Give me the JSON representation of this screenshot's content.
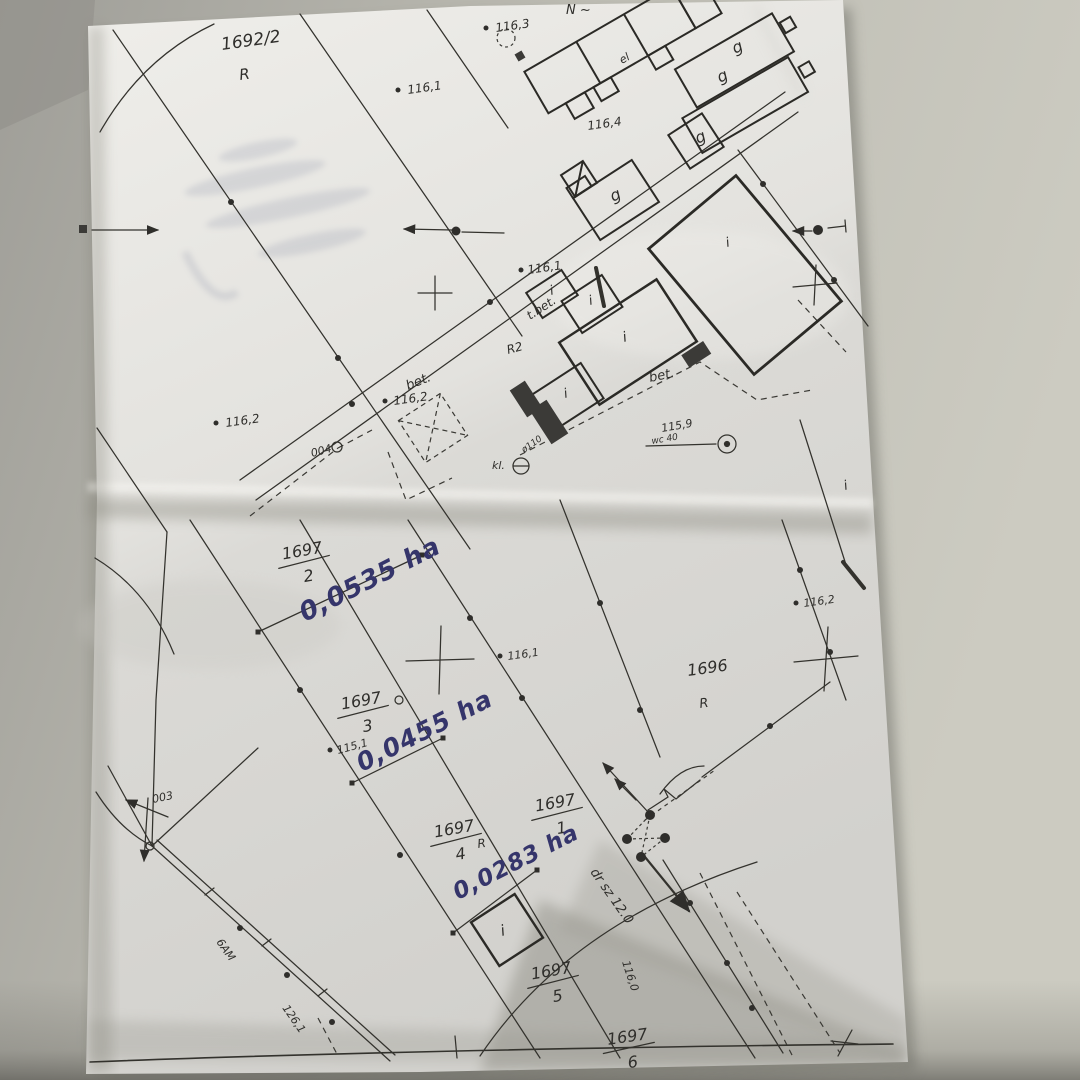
{
  "parcels": {
    "p1692_2": {
      "number": "1692/2",
      "cls": "R"
    },
    "p1696": {
      "number": "1696",
      "cls": "R"
    },
    "p1697_2": {
      "num": "1697",
      "den": "2"
    },
    "p1697_3": {
      "num": "1697",
      "den": "3"
    },
    "p1697_4": {
      "num": "1697",
      "den": "4",
      "cls": "R"
    },
    "p1697_1": {
      "num": "1697",
      "den": "1"
    },
    "p1697_5": {
      "num": "1697",
      "den": "5"
    },
    "p1697_6": {
      "num": "1697",
      "den": "6"
    }
  },
  "areas_handwritten": {
    "a1": "0,0535 ha",
    "a2": "0,0455 ha",
    "a3": "0,0283 ha"
  },
  "spot_heights": {
    "s1": "116,1",
    "s2": "116,3",
    "s3": "116,4",
    "s4": "116,1",
    "s5": "116,2",
    "s6": "116,2",
    "s7": "115,9",
    "s8": "115,1",
    "s9": "116,1",
    "s10": "116,2",
    "s11": "116,0",
    "s12": "126,1"
  },
  "annotations": {
    "north": "N ~",
    "el": "el",
    "t_bet": "t.bet.",
    "r2": "R2",
    "bet_a": "bet.",
    "bet_b": "bet.",
    "wc": "wc 40",
    "kl": "kl.",
    "pipe": "ø110",
    "p004": "004",
    "p003": "003",
    "dr_sz": "dr sz 12.0",
    "road": "6AM"
  },
  "building_letters": {
    "garage": "g",
    "interior": "i"
  },
  "colors": {
    "ink": "#2f2e2b",
    "handwriting": "#35356b",
    "paper": "#e7e5e1",
    "background": "#c2c1b8"
  }
}
